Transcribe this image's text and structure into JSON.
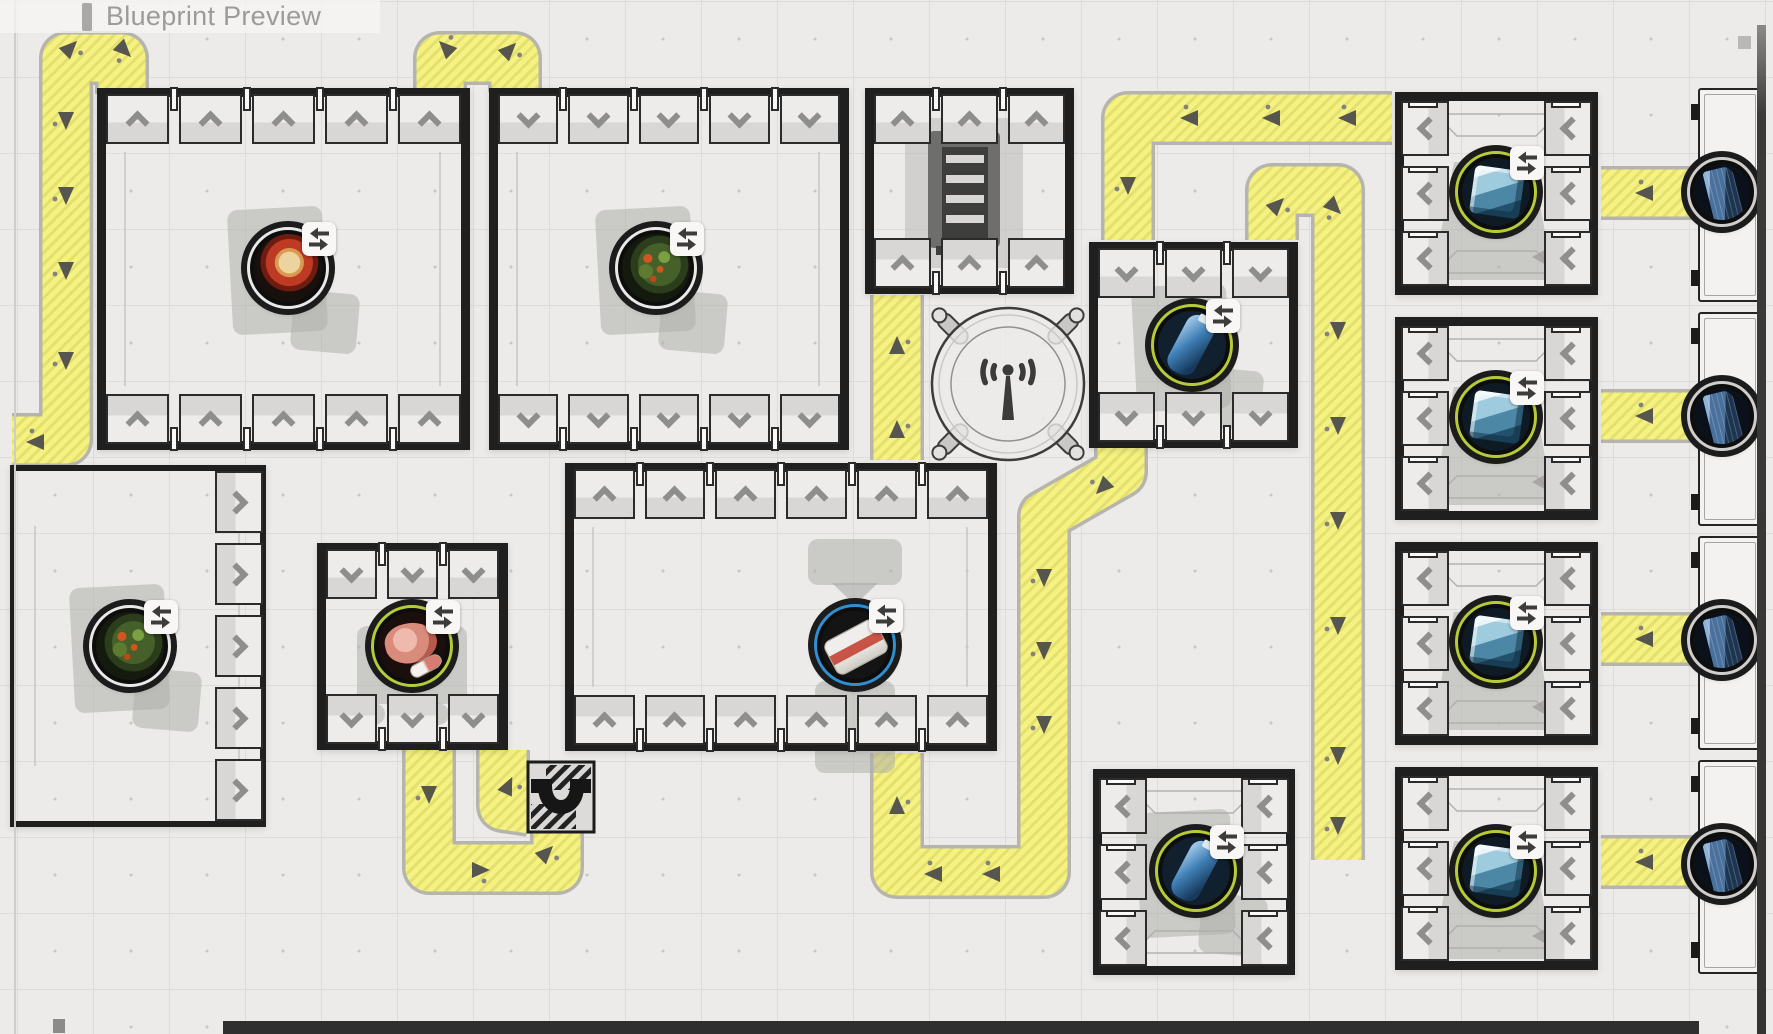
{
  "title": {
    "text": "Blueprint Preview"
  },
  "colors": {
    "background": "#ecebe9",
    "grid_line": "#dedcda",
    "wall": "#1f1f1f",
    "belt_yellow": "#f5f282",
    "belt_stripe": "#e4e070",
    "belt_casing": "#b6b5ad",
    "arrow": "#56564f",
    "ghost": "#afaeac",
    "shelf_border": "#2b2b2b",
    "chevron": "#8e8e8c",
    "edge_dark": "#2f2f2f",
    "ring_white": "#e9e9e7",
    "ring_green": "#b6cc37",
    "ring_blue": "#2f8fd0",
    "ring_silver": "#cfcecc"
  },
  "rooms": [
    {
      "name": "pantry-a",
      "x": 97,
      "y": 88,
      "w": 373,
      "h": 362,
      "wall": 9,
      "corner_lines": true,
      "shelves": [
        {
          "side": "top",
          "count": 5,
          "chevron": "up"
        },
        {
          "side": "bottom",
          "count": 5,
          "chevron": "up"
        }
      ]
    },
    {
      "name": "pantry-b",
      "x": 489,
      "y": 88,
      "w": 360,
      "h": 362,
      "wall": 9,
      "corner_lines": true,
      "shelves": [
        {
          "side": "top",
          "count": 5,
          "chevron": "down"
        },
        {
          "side": "bottom",
          "count": 5,
          "chevron": "down"
        }
      ]
    },
    {
      "name": "kitchen-store",
      "x": 865,
      "y": 88,
      "w": 209,
      "h": 206,
      "wall": 9,
      "shelves": [
        {
          "side": "top",
          "count": 3,
          "chevron": "up"
        },
        {
          "side": "bottom",
          "count": 3,
          "chevron": "up"
        }
      ]
    },
    {
      "name": "bottle-store-north",
      "x": 1089,
      "y": 242,
      "w": 209,
      "h": 206,
      "wall": 9,
      "shelves": [
        {
          "side": "top",
          "count": 3,
          "chevron": "down"
        },
        {
          "side": "bottom",
          "count": 3,
          "chevron": "down"
        }
      ]
    },
    {
      "name": "meat-store",
      "x": 317,
      "y": 543,
      "w": 191,
      "h": 207,
      "wall": 9,
      "shelves": [
        {
          "side": "top",
          "count": 3,
          "chevron": "down"
        },
        {
          "side": "bottom",
          "count": 3,
          "chevron": "down"
        }
      ]
    },
    {
      "name": "packing-hall",
      "x": 565,
      "y": 463,
      "w": 432,
      "h": 288,
      "wall": 9,
      "corner_lines": true,
      "shelves": [
        {
          "side": "top",
          "count": 6,
          "chevron": "up"
        },
        {
          "side": "bottom",
          "count": 6,
          "chevron": "up"
        }
      ]
    },
    {
      "name": "west-store",
      "x": 10,
      "y": 465,
      "w": 256,
      "h": 362,
      "wall": 6,
      "corner_lines": true,
      "shelves": [
        {
          "side": "right",
          "count": 5,
          "chevron": "right",
          "tick": false
        }
      ]
    },
    {
      "name": "cold-store-1",
      "x": 1395,
      "y": 92,
      "w": 203,
      "h": 203,
      "wall": 9,
      "floor_marks": true,
      "shelves": [
        {
          "side": "left",
          "count": 3,
          "chevron": "left"
        },
        {
          "side": "right",
          "count": 3,
          "chevron": "left"
        }
      ]
    },
    {
      "name": "cold-store-2",
      "x": 1395,
      "y": 317,
      "w": 203,
      "h": 203,
      "wall": 9,
      "floor_marks": true,
      "shelves": [
        {
          "side": "left",
          "count": 3,
          "chevron": "left"
        },
        {
          "side": "right",
          "count": 3,
          "chevron": "left"
        }
      ]
    },
    {
      "name": "cold-store-3",
      "x": 1395,
      "y": 542,
      "w": 203,
      "h": 203,
      "wall": 9,
      "floor_marks": true,
      "shelves": [
        {
          "side": "left",
          "count": 3,
          "chevron": "left"
        },
        {
          "side": "right",
          "count": 3,
          "chevron": "left"
        }
      ]
    },
    {
      "name": "cold-store-4",
      "x": 1395,
      "y": 767,
      "w": 203,
      "h": 203,
      "wall": 9,
      "floor_marks": true,
      "shelves": [
        {
          "side": "left",
          "count": 3,
          "chevron": "left"
        },
        {
          "side": "right",
          "count": 3,
          "chevron": "left"
        }
      ]
    },
    {
      "name": "bottle-store-south",
      "x": 1093,
      "y": 769,
      "w": 202,
      "h": 206,
      "wall": 9,
      "floor_marks": true,
      "shelves": [
        {
          "side": "left",
          "count": 3,
          "chevron": "left"
        },
        {
          "side": "right",
          "count": 3,
          "chevron": "left"
        }
      ]
    }
  ],
  "items": [
    {
      "kind": "tomato-dish",
      "name": "tomato-dish",
      "cx": 288,
      "cy": 268,
      "ring": "white",
      "transfer": true,
      "ghost": "blocks"
    },
    {
      "kind": "herb-plant",
      "name": "herb-plant",
      "cx": 656,
      "cy": 268,
      "ring": "white",
      "transfer": true,
      "ghost": "blocks"
    },
    {
      "kind": "water-bottle",
      "name": "water-bottle-north",
      "cx": 1192,
      "cy": 345,
      "ring": "green",
      "transfer": true,
      "ghost": "blocks"
    },
    {
      "kind": "meat-cut",
      "name": "meat-cut",
      "cx": 412,
      "cy": 646,
      "ring": "green",
      "transfer": true,
      "ghost": "dots"
    },
    {
      "kind": "packaged-goods",
      "name": "packaged-goods",
      "cx": 855,
      "cy": 645,
      "ring": "blue",
      "transfer": true,
      "ghost": "funnel"
    },
    {
      "kind": "herb-plant",
      "name": "herb-plant-west",
      "cx": 130,
      "cy": 646,
      "ring": "white",
      "transfer": true,
      "ghost": "blocks"
    },
    {
      "kind": "ice-block",
      "name": "ice-block-1",
      "cx": 1496,
      "cy": 192,
      "ring": "green",
      "transfer": true,
      "ghost": "trapezoid"
    },
    {
      "kind": "ice-block",
      "name": "ice-block-2",
      "cx": 1496,
      "cy": 417,
      "ring": "green",
      "transfer": true,
      "ghost": "trapezoid"
    },
    {
      "kind": "ice-block",
      "name": "ice-block-3",
      "cx": 1496,
      "cy": 642,
      "ring": "green",
      "transfer": true,
      "ghost": "trapezoid"
    },
    {
      "kind": "ice-block",
      "name": "ice-block-4",
      "cx": 1496,
      "cy": 871,
      "ring": "green",
      "transfer": true,
      "ghost": "trapezoid"
    },
    {
      "kind": "water-bottle",
      "name": "water-bottle-south",
      "cx": 1196,
      "cy": 871,
      "ring": "green",
      "transfer": true,
      "ghost": "blocks"
    },
    {
      "kind": "skyscraper",
      "name": "dock-crate-1",
      "cx": 1722,
      "cy": 192,
      "ring": "silver",
      "transfer": false
    },
    {
      "kind": "skyscraper",
      "name": "dock-crate-2",
      "cx": 1722,
      "cy": 416,
      "ring": "silver",
      "transfer": false
    },
    {
      "kind": "skyscraper",
      "name": "dock-crate-3",
      "cx": 1722,
      "cy": 640,
      "ring": "silver",
      "transfer": false
    },
    {
      "kind": "skyscraper",
      "name": "dock-crate-4",
      "cx": 1722,
      "cy": 864,
      "ring": "silver",
      "transfer": false
    }
  ],
  "structures": [
    {
      "name": "dock-1",
      "x": 1698,
      "y": 88
    },
    {
      "name": "dock-2",
      "x": 1698,
      "y": 312
    },
    {
      "name": "dock-3",
      "x": 1698,
      "y": 536
    },
    {
      "name": "dock-4",
      "x": 1698,
      "y": 760
    }
  ],
  "antenna": {
    "cx": 1008,
    "cy": 384,
    "r": 76
  },
  "tunnel": {
    "x": 528,
    "y": 762,
    "w": 66,
    "h": 70
  },
  "cabinet": {
    "x": 905,
    "y": 118
  },
  "belts": [
    {
      "name": "west-loop",
      "points": [
        [
          122,
          94
        ],
        [
          122,
          58
        ],
        [
          66,
          58
        ],
        [
          66,
          440
        ],
        [
          12,
          440
        ]
      ],
      "arrows": [
        [
          70,
          48,
          45
        ],
        [
          124,
          50,
          135
        ],
        [
          66,
          120,
          180
        ],
        [
          66,
          195,
          180
        ],
        [
          66,
          270,
          180
        ],
        [
          66,
          360,
          180
        ],
        [
          36,
          442,
          270
        ]
      ]
    },
    {
      "name": "ab-hop",
      "points": [
        [
          440,
          92
        ],
        [
          440,
          58
        ],
        [
          515,
          58
        ],
        [
          515,
          92
        ]
      ],
      "arrows": [
        [
          446,
          48,
          315
        ],
        [
          509,
          50,
          45
        ]
      ]
    },
    {
      "name": "north-feed",
      "points": [
        [
          1392,
          118
        ],
        [
          1128,
          118
        ],
        [
          1128,
          240
        ]
      ],
      "arrows": [
        [
          1348,
          118,
          270
        ],
        [
          1272,
          118,
          270
        ],
        [
          1190,
          118,
          270
        ],
        [
          1128,
          185,
          180
        ]
      ]
    },
    {
      "name": "depot-corridor",
      "points": [
        [
          1272,
          240
        ],
        [
          1272,
          190
        ],
        [
          1338,
          190
        ],
        [
          1338,
          860
        ]
      ],
      "arrows": [
        [
          1277,
          205,
          45
        ],
        [
          1334,
          207,
          135
        ],
        [
          1338,
          330,
          180
        ],
        [
          1338,
          425,
          180
        ],
        [
          1338,
          520,
          180
        ],
        [
          1338,
          625,
          180
        ],
        [
          1338,
          755,
          180
        ],
        [
          1338,
          825,
          180
        ]
      ]
    },
    {
      "name": "dock-stub-1",
      "points": [
        [
          1601,
          193
        ],
        [
          1696,
          193
        ]
      ],
      "arrows": [
        [
          1645,
          193,
          270
        ]
      ]
    },
    {
      "name": "dock-stub-2",
      "points": [
        [
          1601,
          416
        ],
        [
          1696,
          416
        ]
      ],
      "arrows": [
        [
          1645,
          416,
          270
        ]
      ]
    },
    {
      "name": "dock-stub-3",
      "points": [
        [
          1601,
          639
        ],
        [
          1696,
          639
        ]
      ],
      "arrows": [
        [
          1645,
          639,
          270
        ]
      ]
    },
    {
      "name": "dock-stub-4",
      "points": [
        [
          1601,
          862
        ],
        [
          1696,
          862
        ]
      ],
      "arrows": [
        [
          1645,
          862,
          270
        ]
      ]
    },
    {
      "name": "pad-return",
      "points": [
        [
          1121,
          448
        ],
        [
          1121,
          472
        ],
        [
          1044,
          516
        ],
        [
          1044,
          872
        ],
        [
          897,
          872
        ],
        [
          897,
          753
        ]
      ],
      "arrows": [
        [
          1103,
          487,
          225
        ],
        [
          1044,
          577,
          180
        ],
        [
          1044,
          650,
          180
        ],
        [
          1044,
          724,
          180
        ],
        [
          992,
          874,
          270
        ],
        [
          934,
          874,
          270
        ],
        [
          897,
          806,
          0
        ]
      ]
    },
    {
      "name": "kitchen-feed",
      "points": [
        [
          897,
          460
        ],
        [
          897,
          295
        ]
      ],
      "arrows": [
        [
          897,
          430,
          0
        ],
        [
          897,
          346,
          0
        ]
      ]
    },
    {
      "name": "pink-loop",
      "points": [
        [
          429,
          750
        ],
        [
          429,
          868
        ],
        [
          557,
          868
        ],
        [
          557,
          832
        ]
      ],
      "arrows": [
        [
          429,
          794,
          180
        ],
        [
          480,
          870,
          90
        ],
        [
          546,
          853,
          45
        ]
      ]
    },
    {
      "name": "tunnel-west",
      "points": [
        [
          503,
          750
        ],
        [
          503,
          806
        ],
        [
          530,
          810
        ]
      ],
      "arrows": [
        [
          508,
          786,
          25
        ]
      ]
    }
  ]
}
